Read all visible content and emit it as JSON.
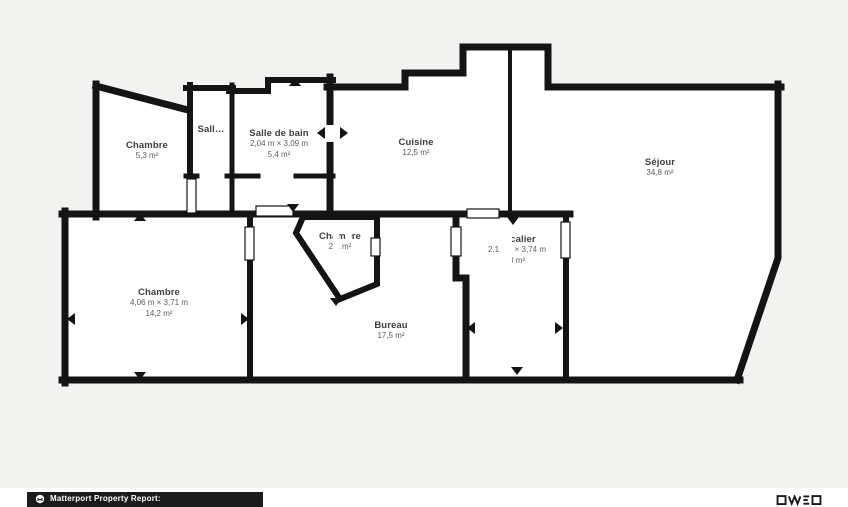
{
  "colors": {
    "wall": "#141414",
    "room_fill": "#ffffff",
    "page_background": "#f2f2f0",
    "footer_background": "#1b1b1b",
    "label_text": "#3e3e3e",
    "sublabel_text": "#5c5c5c"
  },
  "rooms": [
    {
      "id": "chambre-top",
      "name": "Chambre",
      "dims": "",
      "area": "5,3 m²"
    },
    {
      "id": "salle-truncated",
      "name": "Sall…",
      "dims": "",
      "area": ""
    },
    {
      "id": "salle-de-bain",
      "name": "Salle de bain",
      "dims": "2,04 m × 3,09 m",
      "area": "5,4 m²"
    },
    {
      "id": "cuisine",
      "name": "Cuisine",
      "dims": "",
      "area": "12,5 m²"
    },
    {
      "id": "sejour",
      "name": "Séjour",
      "dims": "",
      "area": "34,8 m²"
    },
    {
      "id": "chambre-small",
      "name": "Chambre",
      "dims": "",
      "area": "2,1 m²"
    },
    {
      "id": "escalier",
      "name": "Escalier",
      "dims": "2,14 m × 3,74 m",
      "area": "8 m²"
    },
    {
      "id": "chambre-bottom",
      "name": "Chambre",
      "dims": "4,06 m × 3,71 m",
      "area": "14,2 m²"
    },
    {
      "id": "bureau",
      "name": "Bureau",
      "dims": "",
      "area": "17,5 m²"
    }
  ],
  "footer": {
    "brand": "Matterport Property Report:"
  }
}
